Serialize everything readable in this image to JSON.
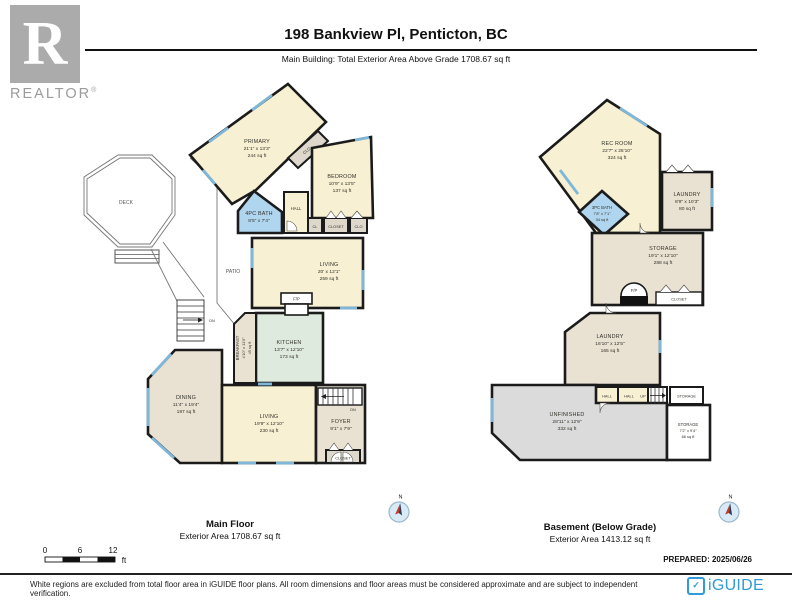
{
  "header": {
    "logo_letter": "R",
    "logo_word": "REALTOR",
    "logo_reg": "®",
    "title": "198 Bankview Pl, Penticton, BC",
    "subtitle": "Main Building: Total Exterior Area Above Grade 1708.67 sq ft"
  },
  "colors": {
    "cream": "#F7F0D2",
    "tan": "#E9E1D2",
    "blue": "#AFD5EF",
    "mint": "#DFEADF",
    "gray_room": "#DBDBDB",
    "closet": "#DDD8CB",
    "white": "#FFFFFF",
    "window": "#7FB7D9",
    "brand_blue": "#2F9CD8",
    "logo_gray": "#ABABAB"
  },
  "main_floor": {
    "caption": {
      "title": "Main Floor",
      "area": "Exterior Area 1708.67 sq ft"
    },
    "rooms": {
      "primary": {
        "name": "PRIMARY",
        "dims": "21'1\" x 13'3\"",
        "area": "244 sq ft"
      },
      "clo_top": {
        "name": "CLO"
      },
      "bedroom": {
        "name": "BEDROOM",
        "dims": "10'9\" x 13'5\"",
        "area": "137 sq ft"
      },
      "bath": {
        "name": "4PC BATH",
        "dims": "8'5\" x 7'4\""
      },
      "hall": {
        "name": "HALL"
      },
      "cl": {
        "name": "CL"
      },
      "closet": {
        "name": "CLOSET"
      },
      "clo": {
        "name": "CLO"
      },
      "living_upper": {
        "name": "LIVING",
        "dims": "20' x 12'1\"",
        "area": "259 sq ft"
      },
      "fp": {
        "name": "F/P"
      },
      "kitchen": {
        "name": "KITCHEN",
        "dims": "13'7\" x 12'10\"",
        "area": "173 sq ft"
      },
      "breakfast": {
        "name": "BREAKFAST",
        "dims": "4'10\" x 11'0\"",
        "area": "45 sq ft"
      },
      "dining": {
        "name": "DINING",
        "dims": "11'4\" x 19'4\"",
        "area": "197 sq ft"
      },
      "living_lower": {
        "name": "LIVING",
        "dims": "19'9\" x 12'10\"",
        "area": "230 sq ft"
      },
      "foyer": {
        "name": "FOYER",
        "dims": "9'1\" x 7'9\""
      },
      "closet_foyer": {
        "name": "CLOSET"
      },
      "deck": {
        "name": "DECK"
      },
      "patio": {
        "name": "PATIO"
      },
      "dn_patio": {
        "name": "DN"
      },
      "dn_foyer": {
        "name": "DN"
      }
    }
  },
  "basement": {
    "caption": {
      "title": "Basement (Below Grade)",
      "area": "Exterior Area 1413.12 sq ft"
    },
    "rooms": {
      "rec_room": {
        "name": "REC ROOM",
        "dims": "22'7\" x 25'10\"",
        "area": "324 sq ft"
      },
      "bath": {
        "name": "3PC BATH",
        "dims": "7'8\" x 7'1\"",
        "area": "34 sq ft"
      },
      "laundry_upper": {
        "name": "LAUNDRY",
        "dims": "8'9\" x 10'3\"",
        "area": "80 sq ft"
      },
      "storage_upper": {
        "name": "STORAGE",
        "dims": "19'1\" x 12'10\"",
        "area": "288 sq ft"
      },
      "fp": {
        "name": "F/P"
      },
      "closet": {
        "name": "CLOSET"
      },
      "laundry_lower": {
        "name": "LAUNDRY",
        "dims": "16'10\" x 12'5\"",
        "area": "165 sq ft"
      },
      "hall": {
        "name": "HALL"
      },
      "hall2": {
        "name": "HALL"
      },
      "up": {
        "name": "UP"
      },
      "storage_hall": {
        "name": "STORAGE"
      },
      "unfinished": {
        "name": "UNFINISHED",
        "dims": "28'11\" x 12'9\"",
        "area": "332 sq ft"
      },
      "storage_lower": {
        "name": "STORAGE",
        "dims": "7'2\" x 9'4\"",
        "area": "66 sq ft"
      }
    }
  },
  "compass": {
    "north": "N"
  },
  "scale_bar": {
    "t0": "0",
    "t6": "6",
    "t12": "12",
    "unit": "ft"
  },
  "prepared": "PREPARED: 2025/06/26",
  "footer": {
    "disclaimer": "White regions are excluded from total floor area in iGUIDE floor plans. All room dimensions and floor areas must be considered approximate and are subject to independent verification.",
    "brand": "iGUIDE"
  }
}
